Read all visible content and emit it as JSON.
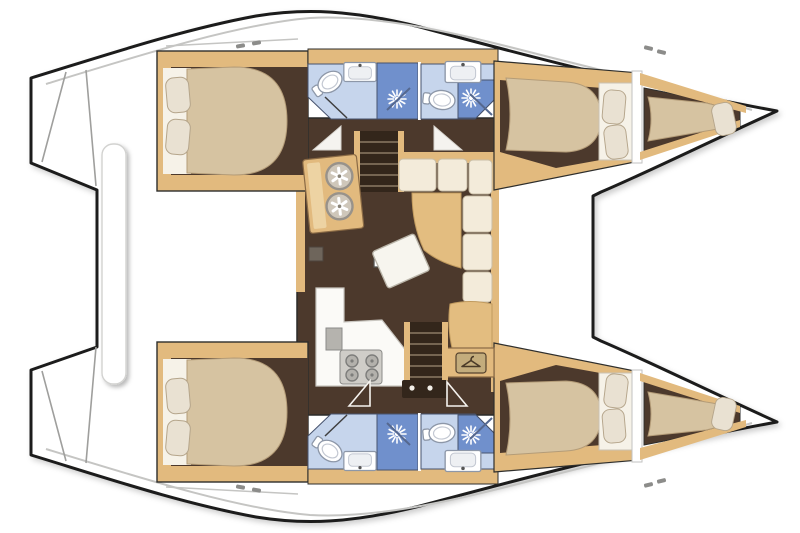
{
  "page": {
    "background": "#ffffff",
    "width": 800,
    "height": 533
  },
  "colors": {
    "background": "#ffffff",
    "deck": "#ffffff",
    "outline": "#1d1d1b",
    "deckLine": "#c5c5c3",
    "stepLine": "#9f9f9d",
    "wood": "#e2ba7e",
    "woodEdge": "#8a6a45",
    "floor": "#4c392c",
    "mattress": "#d6c3a1",
    "mattressEdge": "#b49c78",
    "linen": "#f6f2e8",
    "pillow": "#e9e1d2",
    "pillowEdge": "#b5a58b",
    "bathFloor": "#c6d5ec",
    "bathEdge": "#47536e",
    "shower": "#7090cc",
    "sprayWhite": "#ffffff",
    "fixture": "#ffffff",
    "fixtureEdge": "#8d97a8",
    "sofaBack": "#f3ebda",
    "sofaBackEdge": "#c9bda5",
    "sofaSeat": "#e3bd80",
    "sofaSeatEdge": "#c09a5e",
    "counter": "#fbfaf7",
    "counterEdge": "#c9c6c0",
    "steel": "#cfcdc8",
    "steelEdge": "#8b8b88",
    "stairs": "#33261b",
    "tread": "#8b7a64",
    "hanger": "#4a3a28",
    "hangerPlate": "#c3ac7c",
    "squareGray": "#6e655b",
    "doorLine": "#3f3f3f",
    "wand": "#55688f"
  },
  "plan": {
    "vessel_type": "sailing-catamaran",
    "view": "interior-deck-plan-top-view",
    "saloon": {
      "items": [
        "galley-unit-with-twin-round-sinks",
        "companionway-stairs-forward",
        "companionway-stairs-aft",
        "tilted-dining-table",
        "table-pedestal-base",
        "l-shaped-sofa-with-back-cushions",
        "chaise-corner-seat",
        "wardrobe-with-hanger-plate",
        "galley-counter-with-4-burner-stove",
        "door-swing-marks"
      ]
    },
    "hulls": [
      {
        "position": "top",
        "rooms": [
          {
            "name": "aft-double-cabin",
            "items": [
              "island-double-berth",
              "pillow",
              "pillow"
            ]
          },
          {
            "name": "aft-bathroom",
            "items": [
              "toilet",
              "sink",
              "shower-cubicle"
            ]
          },
          {
            "name": "forward-bathroom",
            "items": [
              "toilet",
              "sink",
              "shower-cubicle"
            ]
          },
          {
            "name": "forward-double-cabin",
            "items": [
              "double-berth",
              "pillow",
              "pillow"
            ]
          },
          {
            "name": "forepeak-berth",
            "items": [
              "single-berth",
              "pillow"
            ]
          }
        ],
        "deck_features": [
          "transom-swim-steps",
          "cleats",
          "side-deck"
        ]
      },
      {
        "position": "bottom",
        "mirrored_copy_of": "top"
      }
    ],
    "between_hulls": [
      "aft-crossbeam-bar",
      "foredeck-edge-line"
    ]
  },
  "icons": {
    "shower": "starburst-spray-icon",
    "galley_sink": "petal-ring-icon",
    "stove": "four-burner-icon",
    "wardrobe": "clothes-hanger-icon",
    "door": "swing-triangle"
  }
}
